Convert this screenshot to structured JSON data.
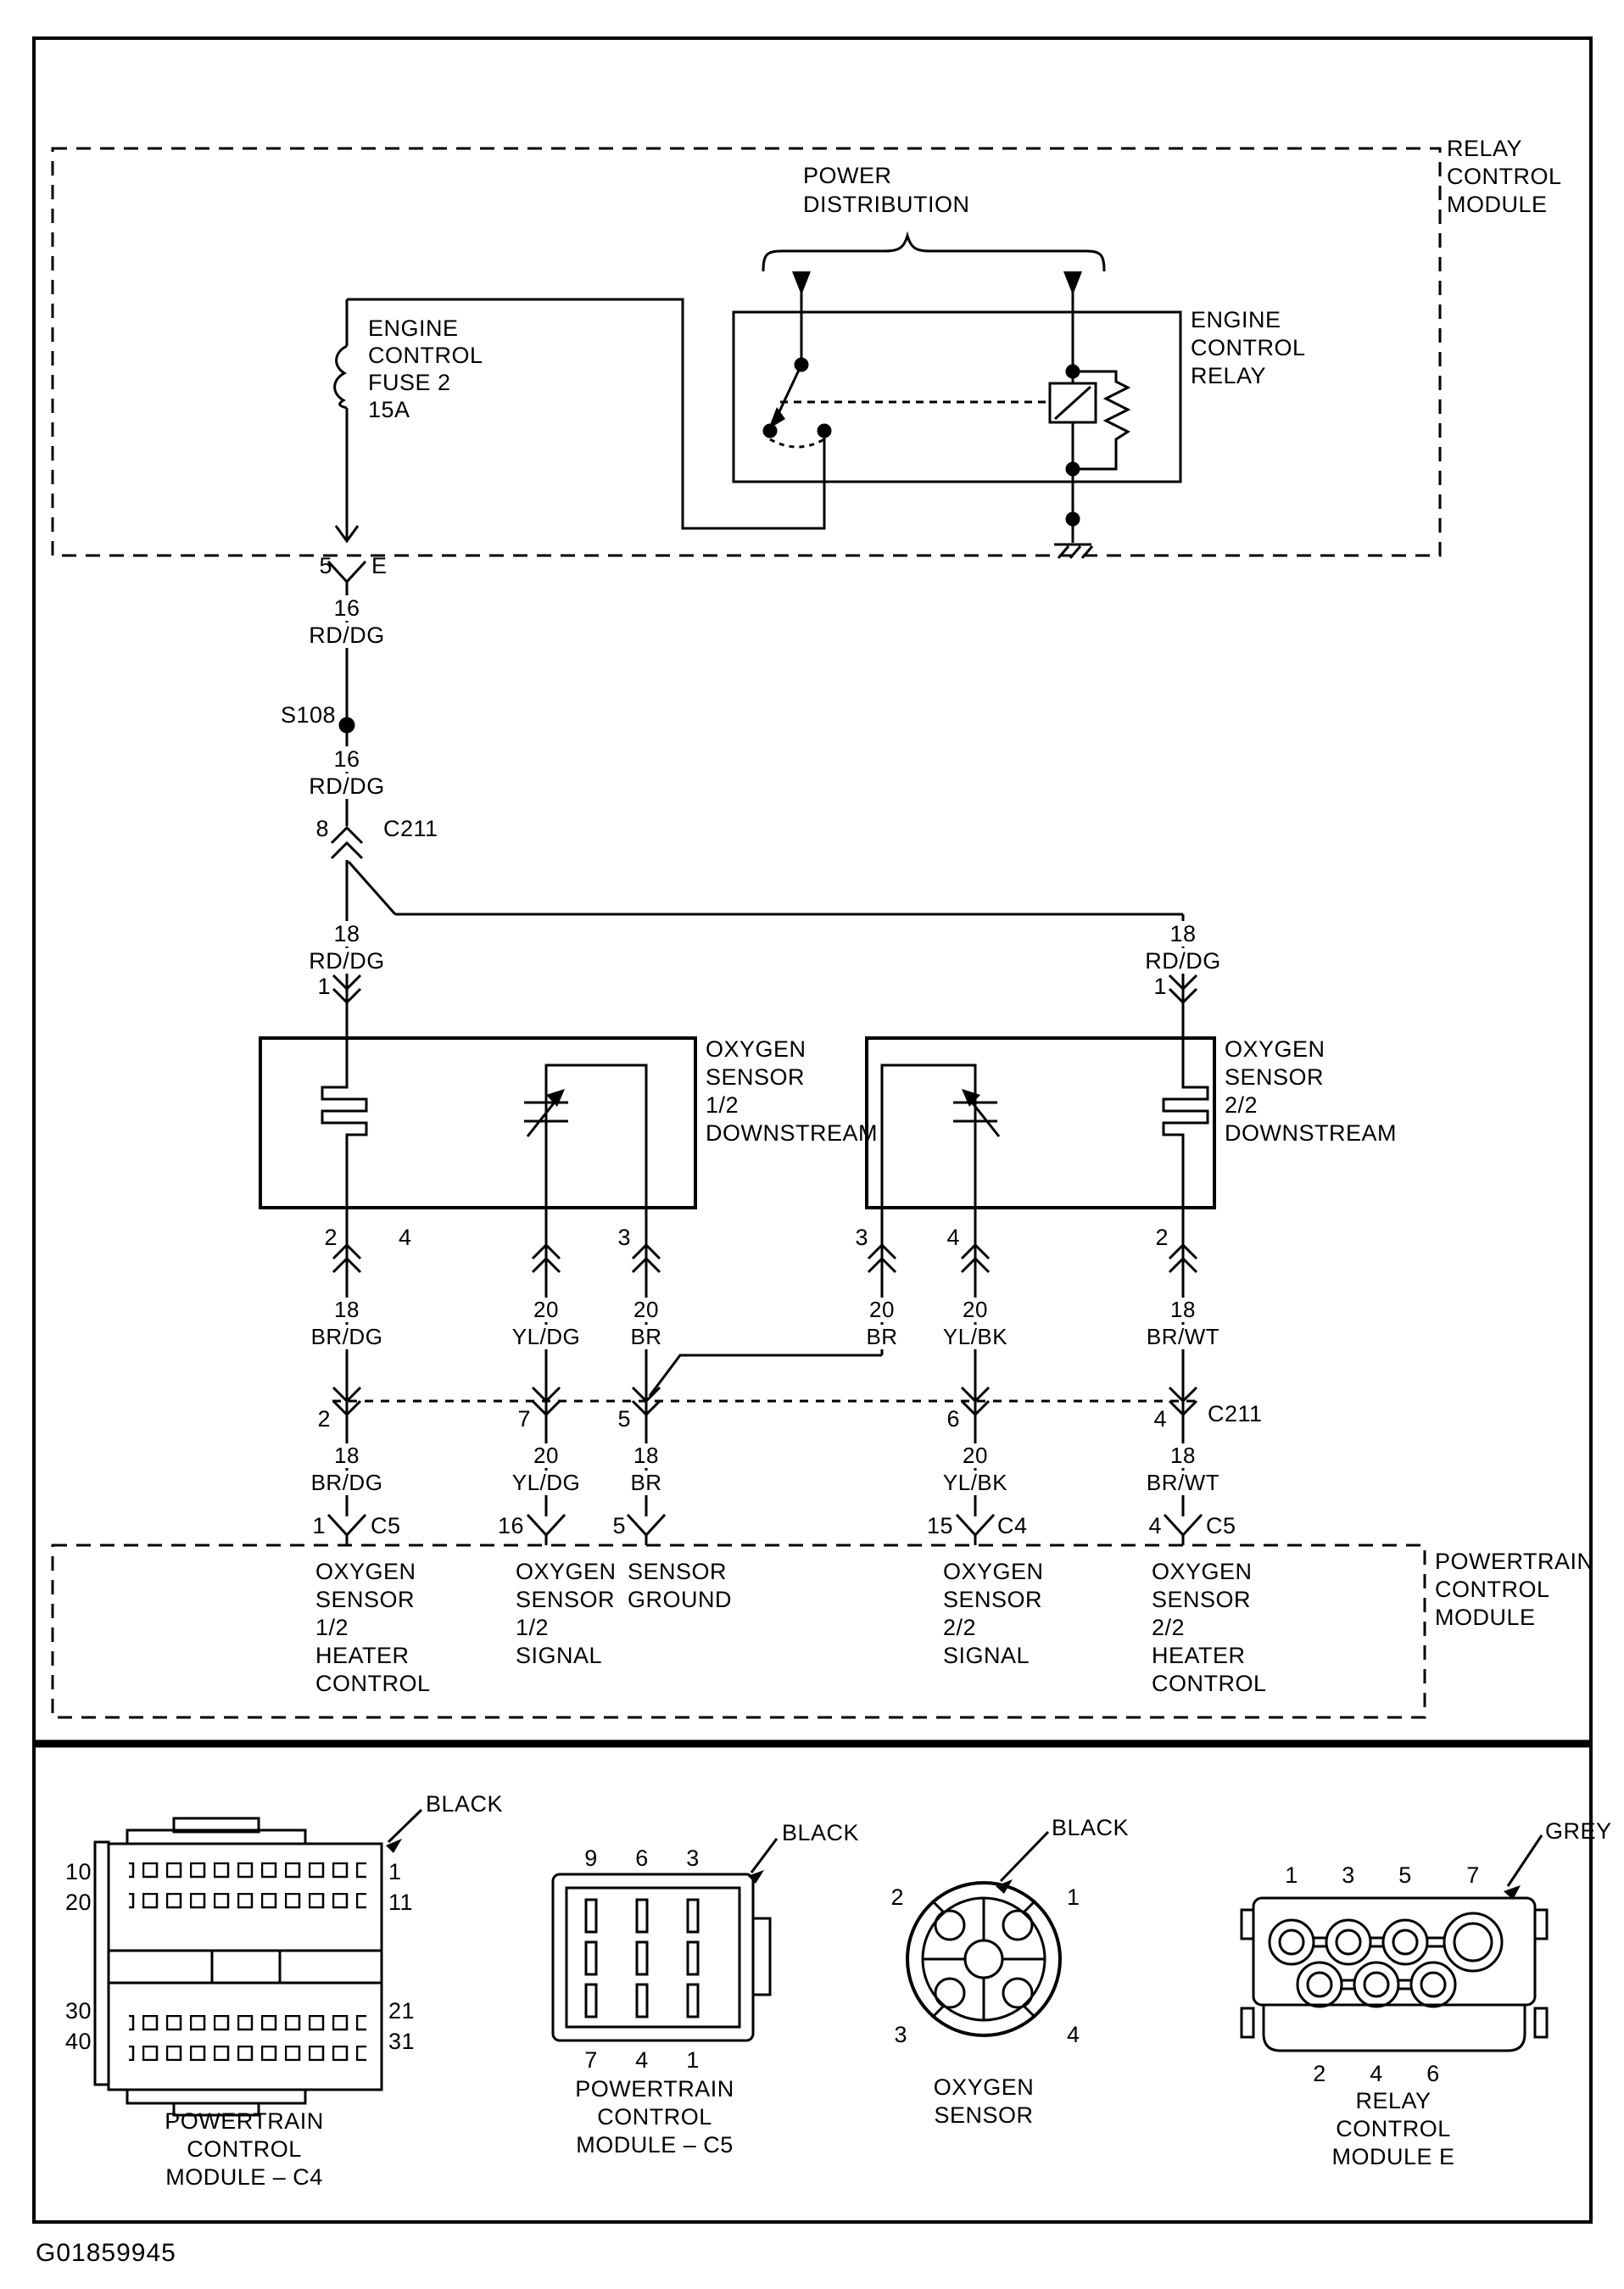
{
  "doc_id": "G01859945",
  "modules": {
    "relay_control_module": [
      "RELAY",
      "CONTROL",
      "MODULE"
    ],
    "powertrain_control_module": [
      "POWERTRAIN",
      "CONTROL",
      "MODULE"
    ]
  },
  "top": {
    "power_distribution": [
      "POWER",
      "DISTRIBUTION"
    ],
    "engine_control_relay": [
      "ENGINE",
      "CONTROL",
      "RELAY"
    ],
    "fuse": [
      "ENGINE",
      "CONTROL",
      "FUSE 2",
      "15A"
    ]
  },
  "wireA": {
    "pin5": "5",
    "term": "E",
    "seg1": {
      "gauge": "16",
      "color": "RD/DG"
    },
    "splice": "S108",
    "seg2": {
      "gauge": "16",
      "color": "RD/DG"
    },
    "pin8": "8",
    "conn": "C211",
    "left": {
      "gauge": "18",
      "color": "RD/DG",
      "pin": "1"
    },
    "right": {
      "gauge": "18",
      "color": "RD/DG",
      "pin": "1"
    }
  },
  "sensor12": {
    "label": [
      "OXYGEN",
      "SENSOR",
      "1/2",
      "DOWNSTREAM"
    ],
    "pins": [
      "2",
      "4",
      "3"
    ],
    "wires1": [
      {
        "gauge": "18",
        "color": "BR/DG"
      },
      {
        "gauge": "20",
        "color": "YL/DG"
      },
      {
        "gauge": "20",
        "color": "BR"
      }
    ]
  },
  "sensor22": {
    "label": [
      "OXYGEN",
      "SENSOR",
      "2/2",
      "DOWNSTREAM"
    ],
    "pins": [
      "3",
      "4",
      "2"
    ],
    "wires1": [
      {
        "gauge": "20",
        "color": "BR"
      },
      {
        "gauge": "20",
        "color": "YL/BK"
      },
      {
        "gauge": "18",
        "color": "BR/WT"
      }
    ]
  },
  "midrow": {
    "pins": [
      "2",
      "7",
      "5",
      "6",
      "4"
    ],
    "conn": "C211",
    "wires2": [
      {
        "gauge": "18",
        "color": "BR/DG"
      },
      {
        "gauge": "20",
        "color": "YL/DG"
      },
      {
        "gauge": "18",
        "color": "BR"
      },
      {
        "gauge": "20",
        "color": "YL/BK"
      },
      {
        "gauge": "18",
        "color": "BR/WT"
      }
    ]
  },
  "pcmrow": {
    "pins": [
      {
        "pin": "1",
        "conn": "C5"
      },
      {
        "pin": "16",
        "conn": ""
      },
      {
        "pin": "5",
        "conn": ""
      },
      {
        "pin": "15",
        "conn": "C4"
      },
      {
        "pin": "4",
        "conn": "C5"
      }
    ],
    "functions": {
      "heater12": [
        "OXYGEN",
        "SENSOR",
        "1/2",
        "HEATER",
        "CONTROL"
      ],
      "signal12": [
        "OXYGEN",
        "SENSOR",
        "1/2",
        "SIGNAL"
      ],
      "ground": [
        "SENSOR",
        "GROUND"
      ],
      "signal22": [
        "OXYGEN",
        "SENSOR",
        "2/2",
        "SIGNAL"
      ],
      "heater22": [
        "OXYGEN",
        "SENSOR",
        "2/2",
        "HEATER",
        "CONTROL"
      ]
    }
  },
  "connectors": {
    "c4": {
      "color": "BLACK",
      "left": [
        "10",
        "20",
        "30",
        "40"
      ],
      "right": [
        "1",
        "11",
        "21",
        "31"
      ],
      "caption": [
        "POWERTRAIN",
        "CONTROL",
        "MODULE – C4"
      ]
    },
    "c5": {
      "color": "BLACK",
      "top": [
        "9",
        "6",
        "3"
      ],
      "bottom": [
        "7",
        "4",
        "1"
      ],
      "caption": [
        "POWERTRAIN",
        "CONTROL",
        "MODULE – C5"
      ]
    },
    "o2": {
      "color": "BLACK",
      "pins": [
        "2",
        "1",
        "3",
        "4"
      ],
      "caption": [
        "OXYGEN",
        "SENSOR"
      ]
    },
    "relay_e": {
      "color": "GREY",
      "top": [
        "1",
        "3",
        "5",
        "7"
      ],
      "bottom": [
        "2",
        "4",
        "6"
      ],
      "caption": [
        "RELAY",
        "CONTROL",
        "MODULE E"
      ]
    }
  }
}
